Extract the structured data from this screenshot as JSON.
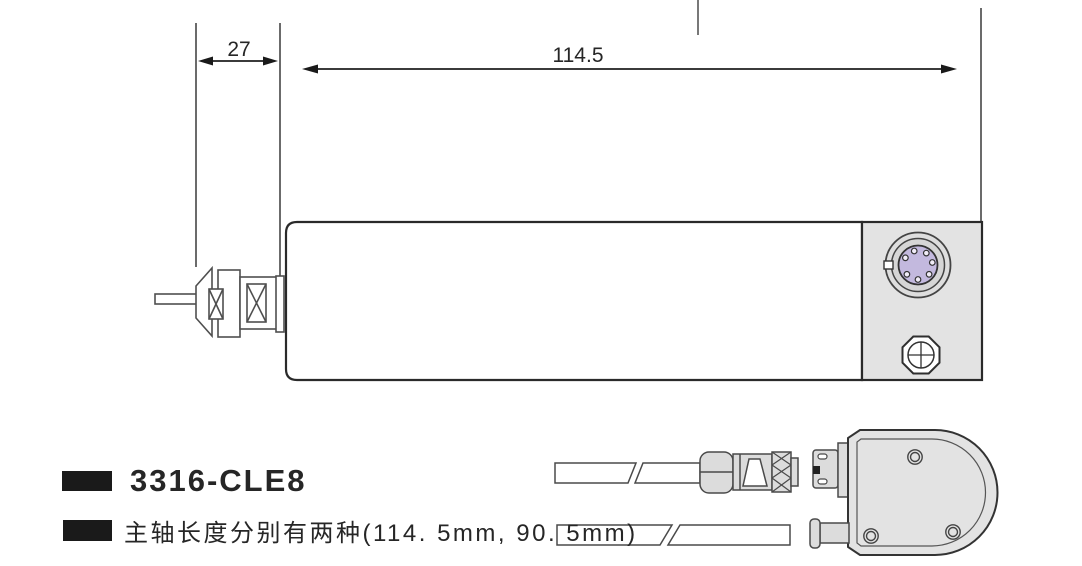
{
  "dimensions": {
    "nose_length": "27",
    "body_length": "114.5",
    "body_diameter": "∅33-0.05"
  },
  "caption": {
    "product_code": "3316-CLE8",
    "note": "主轴长度分别有两种(114. 5mm, 90. 5mm)"
  },
  "colors": {
    "line": "#2f2f2f",
    "metal_gray": "#e3e3e3",
    "plug_gray": "#dcdcdc",
    "connector_purple": "#c3b9de",
    "marker_black": "#1a1a1a",
    "text": "#262626"
  }
}
